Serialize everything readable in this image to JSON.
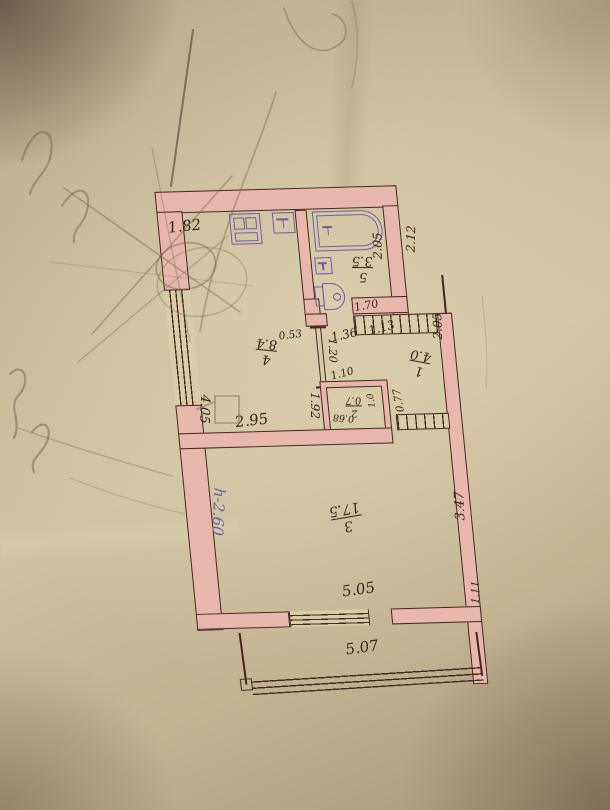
{
  "rooms": {
    "hall": {
      "number": "1",
      "area": "4.0"
    },
    "closet": {
      "number": "2",
      "area": "0.7"
    },
    "living_room": {
      "number": "3",
      "area": "17.5"
    },
    "kitchen": {
      "number": "4",
      "area": "8.4"
    },
    "bathroom": {
      "number": "5",
      "area": "3.5"
    }
  },
  "dimensions": {
    "kitchen_top": "1.82",
    "bath_depth": "2.05",
    "bath_right_outside": "2.12",
    "bath_width": "1.70",
    "hall_top_left": "1.36",
    "hall_top_right": "1.13",
    "hall_right": "2.05",
    "kitchen_door_stub": "0.53",
    "partition_opening": "1.20",
    "closet_top": "1.10",
    "closet_inner_depth": "1.0",
    "closet_door": "0.77",
    "closet_inner_width": "0.68",
    "kitchen_right": "1.92",
    "kitchen_left": "4.05",
    "kitchen_bottom": "2.95",
    "living_right": "3.47",
    "living_bottom": "5.05",
    "balcony_side": "1.11",
    "balcony_front": "5.07"
  },
  "annotations": {
    "ceiling_height": "h-2.60"
  },
  "fixtures": {
    "bathtub": "bathtub",
    "wash_basin": "wash-basin",
    "toilet": "toilet",
    "stove": "stove",
    "kitchen_sink": "kitchen-sink"
  },
  "colors": {
    "ink": "#43291c",
    "wall_fill": "#e8b7ab",
    "purple_ink": "#6c5fa7",
    "pencil": "#6e604c",
    "paper": "#c9bb9a"
  }
}
